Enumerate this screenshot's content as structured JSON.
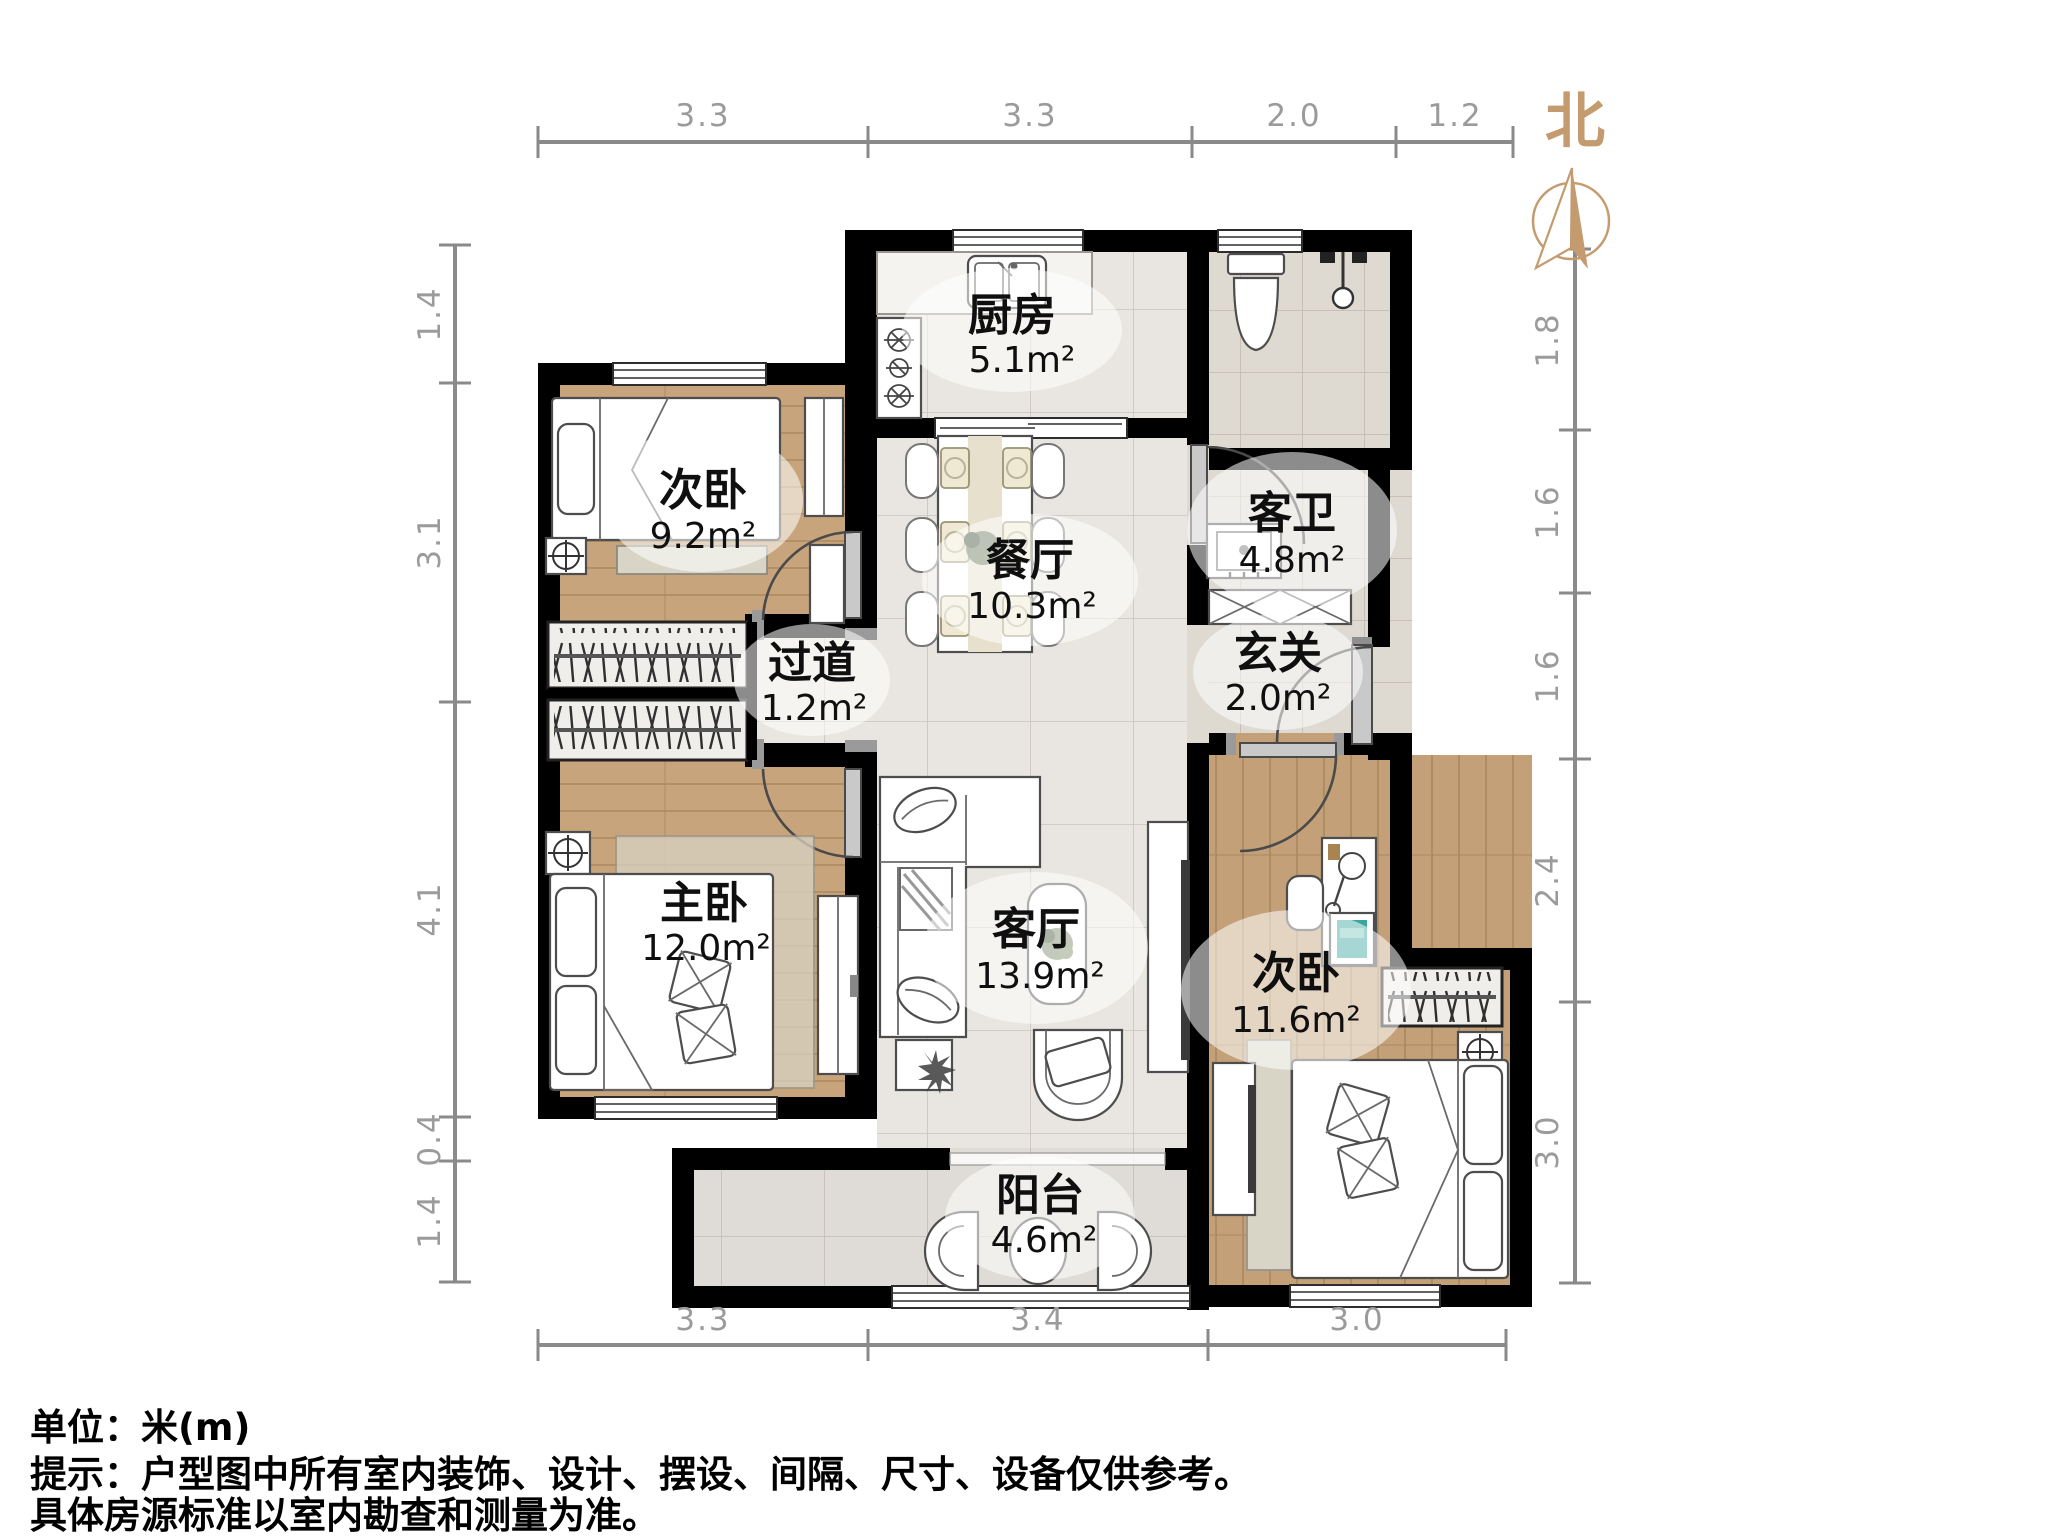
{
  "plan": {
    "north_label": "北",
    "rooms": [
      {
        "id": "bedroom-top",
        "name": "次卧",
        "area": "9.2m²"
      },
      {
        "id": "kitchen",
        "name": "厨房",
        "area": "5.1m²"
      },
      {
        "id": "guest-bath",
        "name": "客卫",
        "area": "4.8m²"
      },
      {
        "id": "dining",
        "name": "餐厅",
        "area": "10.3m²"
      },
      {
        "id": "hallway",
        "name": "过道",
        "area": "1.2m²"
      },
      {
        "id": "entry",
        "name": "玄关",
        "area": "2.0m²"
      },
      {
        "id": "master",
        "name": "主卧",
        "area": "12.0m²"
      },
      {
        "id": "living",
        "name": "客厅",
        "area": "13.9m²"
      },
      {
        "id": "bedroom-right",
        "name": "次卧",
        "area": "11.6m²"
      },
      {
        "id": "balcony",
        "name": "阳台",
        "area": "4.6m²"
      }
    ],
    "dimensions": {
      "top": [
        "3.3",
        "3.3",
        "2.0",
        "1.2"
      ],
      "bottom": [
        "3.3",
        "3.4",
        "3.0"
      ],
      "left": [
        "1.4",
        "3.1",
        "4.1",
        "0.4",
        "1.4"
      ],
      "right": [
        "1.8",
        "1.6",
        "1.6",
        "2.4",
        "3.0"
      ]
    },
    "notes": [
      "单位：米(m)",
      "提示：户型图中所有室内装饰、设计、摆设、间隔、尺寸、设备仅供参考。",
      "具体房源标准以室内勘查和测量为准。"
    ],
    "colors": {
      "accent": "#C49B6F",
      "wall": "#000000",
      "wood": "#c8a47c",
      "tile": "#e9e6e1",
      "dim_text": "#9b9b9b"
    }
  }
}
